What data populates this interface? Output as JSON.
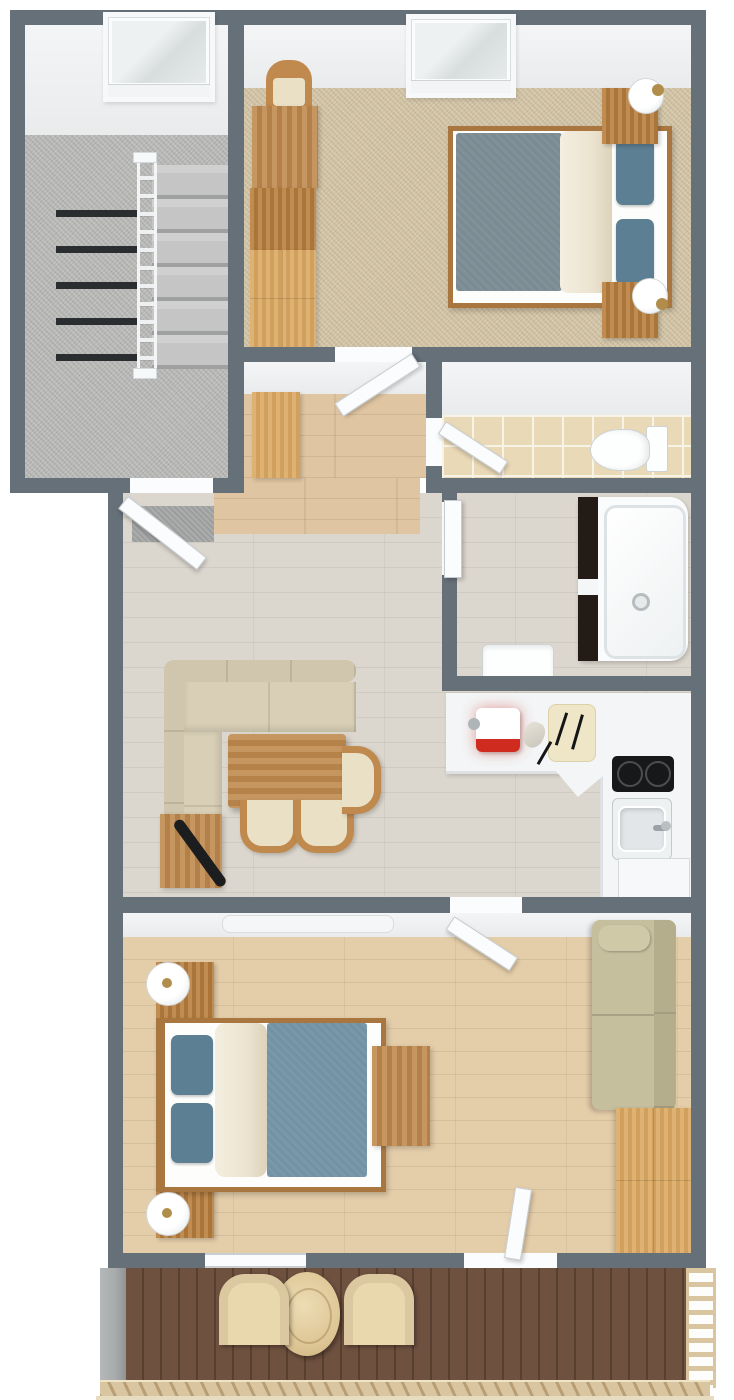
{
  "title": "3D top-down floor plan render of a one-bedroom attic apartment with balcony",
  "colors": {
    "wall": "#667079",
    "staircarpet": "#b6b7b5",
    "tancarpet": "#cfc0a0",
    "hallwood": "#dfc5a1",
    "livingwood": "#dcd7ce",
    "oakfloor": "#e4cda9",
    "deck": "#6f5140",
    "deckgap": "#57402f",
    "tile": "#ead9b6",
    "grout": "#f8f3e7",
    "counter": "#f3f5f6",
    "cooktop": "#17181a",
    "woodmid": "#c08a4e",
    "woodlight": "#d9a760",
    "wooddark": "#b97f3e",
    "woodframe": "#a9763f",
    "sofacream": "#d8cfb6",
    "sofacreamback": "#cfc6ad",
    "sofakhaki": "#c6bf9d",
    "sofakhakiback": "#b5ae8d",
    "duvet1": "#7b8b93",
    "duvet2": "#7292a5",
    "pillow": "#5d7f93",
    "blanket": "#ece4d0",
    "door": "#fbfcfd",
    "red": "#cf2b1e",
    "railtan": "#d9c5a0",
    "concrete": "#a7abac",
    "tubpanel": "#241b16",
    "mat": "#9c9e9d",
    "tread": "#2b2e31",
    "lampgold": "#b08d4a"
  },
  "rooms": [
    {
      "id": "stairwell",
      "floor": "gray carpet",
      "features": [
        "staircase-two-flights",
        "stair-railing",
        "skylight"
      ]
    },
    {
      "id": "bedroom-top",
      "floor": "tan carpet",
      "features": [
        "skylight"
      ],
      "furniture": [
        "double-bed-blue-duvet",
        "nightstand",
        "table-lamp",
        "nightstand",
        "table-lamp",
        "desk",
        "chair",
        "dresser",
        "wardrobe"
      ]
    },
    {
      "id": "hallway",
      "floor": "oak parquet",
      "furniture": [
        "wardrobe"
      ]
    },
    {
      "id": "wc",
      "floor": "beige tile",
      "furniture": [
        "toilet"
      ]
    },
    {
      "id": "bathroom",
      "floor": "beige tile",
      "furniture": [
        "bathtub",
        "sink"
      ]
    },
    {
      "id": "living-dining",
      "floor": "light gray-oak parquet",
      "furniture": [
        "corner-sofa",
        "dining-table",
        "dining-chair",
        "dining-chair",
        "dining-chair",
        "sideboard",
        "doormat"
      ]
    },
    {
      "id": "kitchen",
      "floor": "light gray-oak parquet",
      "furniture": [
        "l-shaped-counter",
        "coffee-machine-red",
        "grinder",
        "cutting-board",
        "knives",
        "two-burner-cooktop",
        "kitchen-sink",
        "dishwasher"
      ]
    },
    {
      "id": "bedroom-bottom",
      "floor": "oak parquet",
      "furniture": [
        "double-bed-blue-duvet",
        "nightstand",
        "table-lamp",
        "nightstand",
        "table-lamp",
        "desk",
        "sofa",
        "wardrobe",
        "radiator"
      ]
    },
    {
      "id": "balcony",
      "floor": "dark wood decking",
      "furniture": [
        "round-table",
        "deck-chair",
        "deck-chair"
      ],
      "features": [
        "concrete-side-rail",
        "slat-railing",
        "ladder-railing"
      ]
    }
  ],
  "doors": [
    "apartment-entry-door",
    "bedroom-top-door",
    "wc-door",
    "bathroom-door",
    "bedroom-bottom-door",
    "balcony-door"
  ],
  "windows": [
    "stairwell-skylight",
    "bedroom-top-skylight",
    "bedroom-bottom-window"
  ]
}
